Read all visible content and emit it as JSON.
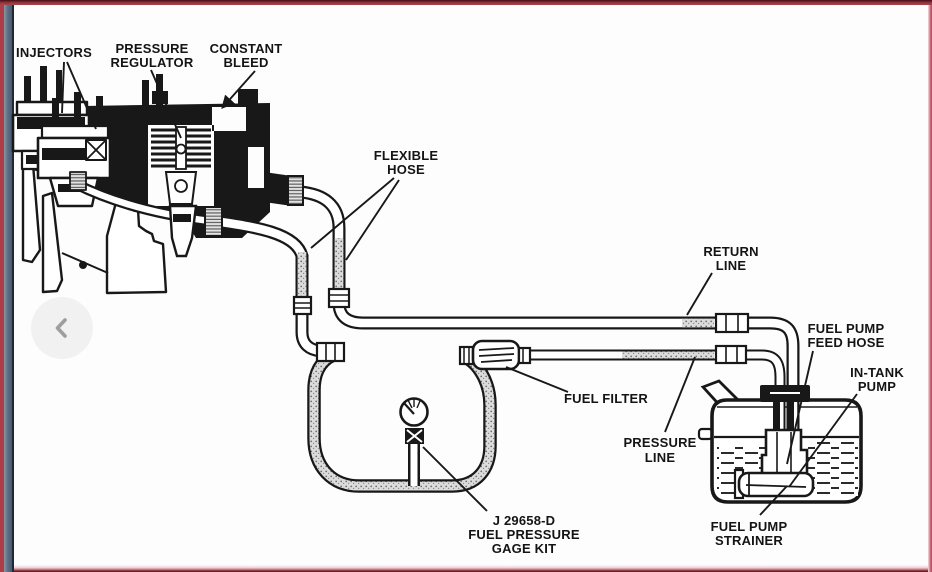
{
  "window": {
    "frame_colors": {
      "top_maroon": "#93363e",
      "left_red": "#ad3e47",
      "left_slate": "#5d7186",
      "left_navy": "#1f2834",
      "right_pink": "#c2586c",
      "bottom_maroon": "#511019"
    },
    "background": "#fdfdfd"
  },
  "carousel": {
    "prev_icon": "chevron-left",
    "prev_icon_color": "#9e9e9e",
    "prev_button_color": "#f1f1f1"
  },
  "diagram": {
    "ink_color": "#181818",
    "labels": {
      "injectors": [
        "INJECTORS"
      ],
      "pressure_regulator": [
        "PRESSURE",
        "REGULATOR"
      ],
      "constant_bleed": [
        "CONSTANT",
        "BLEED"
      ],
      "flexible_hose": [
        "FLEXIBLE",
        "HOSE"
      ],
      "return_line": [
        "RETURN",
        "LINE"
      ],
      "fuel_pump_feed_hose": [
        "FUEL PUMP",
        "FEED HOSE"
      ],
      "in_tank_pump": [
        "IN-TANK",
        "PUMP"
      ],
      "fuel_filter": [
        "FUEL FILTER"
      ],
      "pressure_line": [
        "PRESSURE",
        "LINE"
      ],
      "gage_kit": [
        "J 29658-D",
        "FUEL PRESSURE",
        "GAGE KIT"
      ],
      "fuel_pump_strainer": [
        "FUEL PUMP",
        "STRAINER"
      ]
    }
  }
}
